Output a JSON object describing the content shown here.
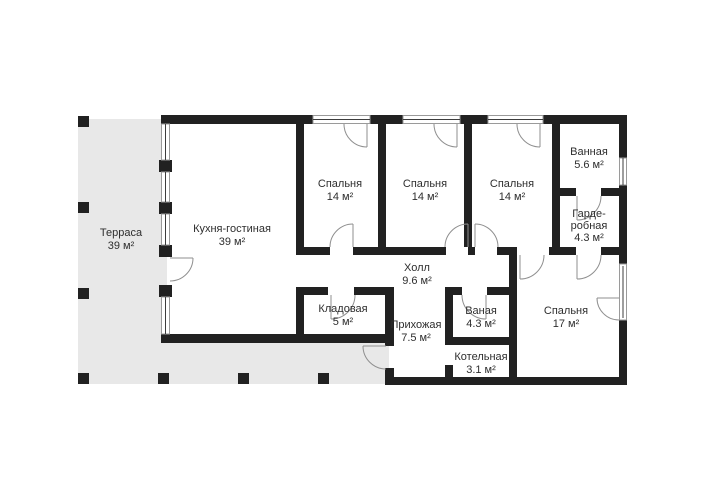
{
  "plan": {
    "title": "floor-plan",
    "colors": {
      "wall": "#212121",
      "terrace": "#e8e8e8",
      "door_line": "#8f8f8f",
      "window_line": "#3d3d3d",
      "text": "#2e2e2e"
    },
    "rooms": [
      {
        "id": "terrace",
        "name": "Терраса",
        "area": "39 м²"
      },
      {
        "id": "kitchen-living",
        "name": "Кухня-гостиная",
        "area": "39 м²"
      },
      {
        "id": "bedroom-1",
        "name": "Спальня",
        "area": "14 м²"
      },
      {
        "id": "bedroom-2",
        "name": "Спальня",
        "area": "14 м²"
      },
      {
        "id": "bedroom-3",
        "name": "Спальня",
        "area": "14 м²"
      },
      {
        "id": "bathroom-main",
        "name": "Ванная",
        "area": "5.6 м²"
      },
      {
        "id": "wardrobe",
        "name_line1": "Гарде-",
        "name_line2": "робная",
        "area": "4.3 м²"
      },
      {
        "id": "hall",
        "name": "Холл",
        "area": "9.6 м²"
      },
      {
        "id": "storage",
        "name": "Кладовая",
        "area": "5 м²"
      },
      {
        "id": "entry",
        "name": "Прихожая",
        "area": "7.5 м²"
      },
      {
        "id": "bathroom-small",
        "name": "Ваная",
        "area": "4.3 м²"
      },
      {
        "id": "boiler",
        "name": "Котельная",
        "area": "3.1 м²"
      },
      {
        "id": "bedroom-4",
        "name": "Спальня",
        "area": "17 м²"
      }
    ]
  }
}
